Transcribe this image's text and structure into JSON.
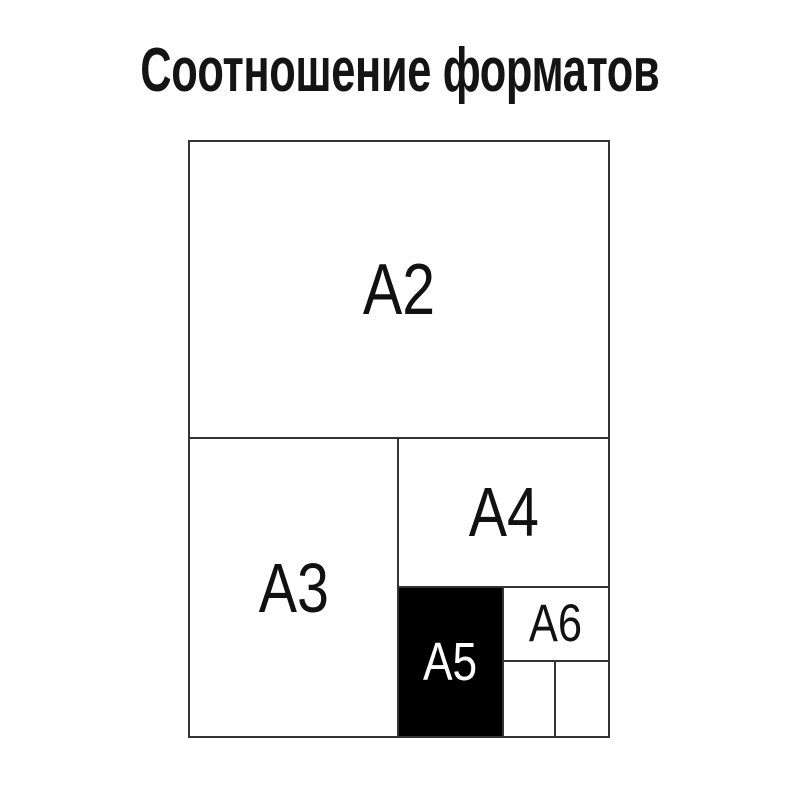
{
  "title": "Соотношение форматов",
  "diagram": {
    "formats": {
      "a2": {
        "label": "A2",
        "highlighted": false
      },
      "a3": {
        "label": "A3",
        "highlighted": false
      },
      "a4": {
        "label": "A4",
        "highlighted": false
      },
      "a5": {
        "label": "A5",
        "highlighted": true
      },
      "a6": {
        "label": "A6",
        "highlighted": false
      }
    },
    "colors": {
      "background": "#ffffff",
      "line": "#333333",
      "label_text": "#111111",
      "highlight_background": "#000000",
      "highlight_text": "#ffffff"
    }
  }
}
